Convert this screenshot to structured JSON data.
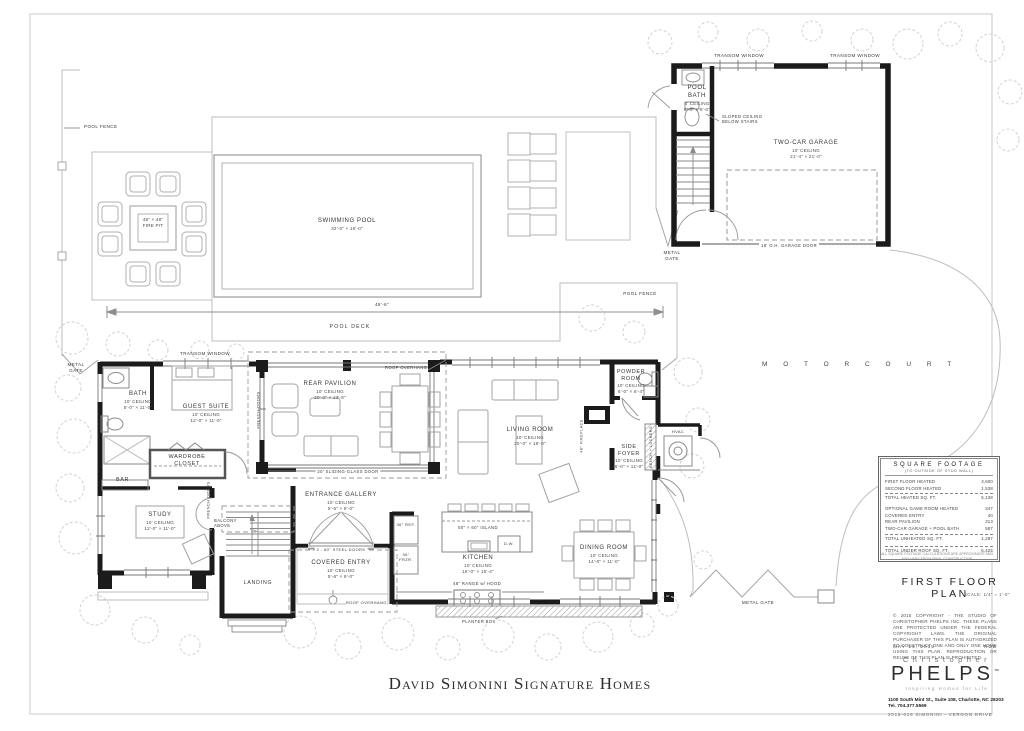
{
  "sheet": {
    "main_title": "David Simonini Signature Homes"
  },
  "rooms": {
    "bath": {
      "name": "BATH",
      "ceiling": "10' CEILING",
      "size": "5'-0\" × 11'-0\""
    },
    "guest_suite": {
      "name": "GUEST SUITE",
      "ceiling": "10' CEILING",
      "size": "12'-0\" × 11'-0\""
    },
    "wardrobe": {
      "name": "WARDROBE CLOSET"
    },
    "bar": {
      "name": "BAR"
    },
    "study": {
      "name": "STUDY",
      "ceiling": "10' CEILING",
      "size": "12'-0\" × 11'-0\""
    },
    "rear_pavilion": {
      "name": "REAR PAVILION",
      "ceiling": "10' CEILING",
      "size": "20'-0\" × 13'-8\""
    },
    "entrance_gallery": {
      "name": "ENTRANCE GALLERY",
      "ceiling": "10' CEILING",
      "size": "5'-6\" × 8'-0\""
    },
    "covered_entry": {
      "name": "COVERED ENTRY",
      "ceiling": "10' CEILING",
      "size": "5'-6\" × 9'-0\""
    },
    "landing": {
      "name": "LANDING"
    },
    "living": {
      "name": "LIVING ROOM",
      "ceiling": "10' CEILING",
      "size": "20'-0\" × 18'-0\""
    },
    "powder": {
      "name": "POWDER ROOM",
      "ceiling": "10' CEILING",
      "size": "6'-0\" × 6'-4\""
    },
    "side_foyer": {
      "name": "SIDE FOYER",
      "ceiling": "10' CEILING",
      "size": "6'-0\" × 11'-0\""
    },
    "kitchen": {
      "name": "KITCHEN",
      "ceiling": "10' CEILING",
      "size": "18'-0\" × 15'-4\""
    },
    "dining": {
      "name": "DINING ROOM",
      "ceiling": "10' CEILING",
      "size": "14'-0\" × 11'-0\""
    },
    "pool_bath": {
      "name": "POOL BATH",
      "ceiling": "8' CEILING",
      "size": "6'-0\" × 8'-0\""
    },
    "garage": {
      "name": "TWO-CAR GARAGE",
      "ceiling": "10' CEILING",
      "size": "21'-4\" × 21'-0\""
    }
  },
  "labels": {
    "pool_fence": "POOL FENCE",
    "metal_gate": "METAL GATE",
    "pool_deck": "POOL DECK",
    "deck_dim": "48'-6\"",
    "swimming_pool": "SWIMMING POOL",
    "pool_size": "32'-0\" × 16'-0\"",
    "fire_pit_size": "48\" × 48\"",
    "fire_pit": "FIRE PIT",
    "motor_court": "M O T O R     C O U R T",
    "transom_window": "TRANSOM WINDOW",
    "sloped_ceiling": "SLOPED CEILING BELOW STAIRS",
    "garage_door": "18' O.H. GARAGE DOOR",
    "roof_overhang": "ROOF OVERHANG",
    "sliding_door": "20' SLIDING-GLASS DOOR",
    "steel_doors": "2 - 60\" STEEL DOORS",
    "french_doors": "FRENCH DOORS",
    "balcony_above": "BALCONY ABOVE",
    "fireplace": "48\" FIREPLACE",
    "bench_lockers": "BENCH + LOCKERS",
    "hvac": "HVAC",
    "island": "50\" × 60\" ISLAND",
    "dw": "D.W.",
    "ref": "36\" REF.",
    "frzr": "36\" FRZR.",
    "range": "48\" RANGE w/ HOOD",
    "planter_box": "PLANTER BOX"
  },
  "square_footage": {
    "title": "SQUARE FOOTAGE",
    "subtitle": "(TO OUTSIDE OF STUD WALL)",
    "rows": [
      {
        "label": "FIRST FLOOR HEATED",
        "value": "3,600"
      },
      {
        "label": "SECOND FLOOR HEATED",
        "value": "1,538"
      },
      {
        "label": "TOTAL HEATED SQ. FT.",
        "value": "5,138"
      },
      {
        "label": "OPTIONAL GAME ROOM HEATED",
        "value": "347"
      },
      {
        "label": "COVERED ENTRY",
        "value": "40"
      },
      {
        "label": "REAR PAVILION",
        "value": "313"
      },
      {
        "label": "TWO-CAR GARAGE + POOL BATH",
        "value": "587"
      },
      {
        "label": "TOTAL UNHEATED SQ. FT.",
        "value": "1,287"
      },
      {
        "label": "TOTAL UNDER ROOF SQ. FT.",
        "value": "6,425"
      }
    ],
    "note": "ALL SQUARE FOOTAGE CALCULATIONS ARE APPROXIMATE AND MAY VARY FROM FINAL CONSTRUCTION"
  },
  "titleblock": {
    "plan_title": "FIRST FLOOR PLAN",
    "scale": "SCALE:  1/4\" = 1'-0\"",
    "copyright": "© 2015 COPYRIGHT - THE STUDIO OF CHRISTOPHER PHELPS INC. THESE PLANS ARE PROTECTED UNDER THE FEDERAL COPYRIGHT LAWS. THE ORIGINAL PURCHASER OF THIS PLAN IS AUTHORIZED TO CONSTRUCT ONE AND ONLY ONE HOME USING THIS PLAN. REPRODUCTION OR REUSE OF THIS PLAN IS PROHIBITED.",
    "date": "MAY 14, 2015",
    "drawn_by": "RDB",
    "logo_first": "Christopher",
    "logo_last": "PHELPS",
    "logo_tm": "™",
    "tagline": "Inspiring Homes for Life",
    "address": "1100 South Mint St., Suite 108, Charlotte, NC  28203",
    "phone": "Tel. 704.377.5569",
    "project": "2015-019   SIMONINI  -  VERNON  DRIVE"
  }
}
